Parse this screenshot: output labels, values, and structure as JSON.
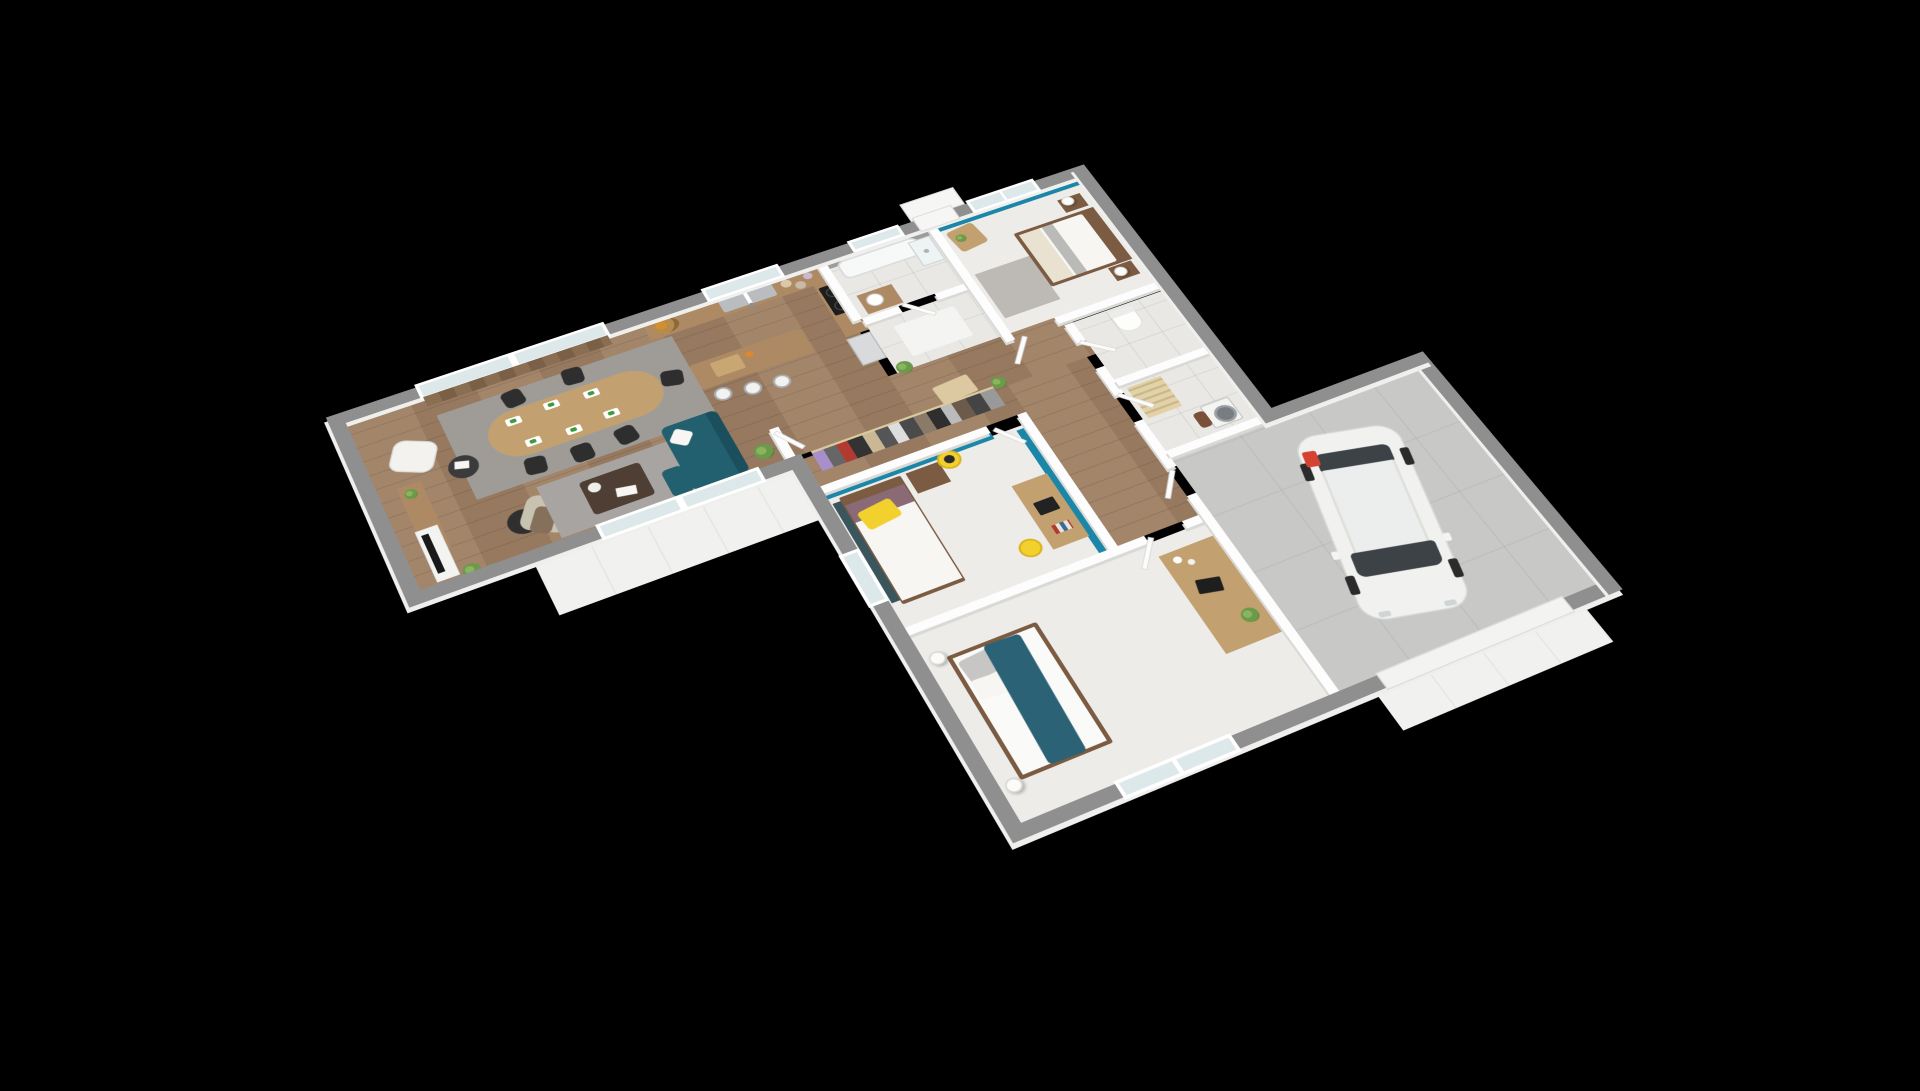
{
  "scene": {
    "title": "3D isometric floor plan render of a single-storey house with garage",
    "background": "#000000",
    "view": "rotated top-down axonometric, house floats on black"
  },
  "palette": {
    "bg": "#000000",
    "wall_ext": "#8f8f8f",
    "wall_ext_face": "#efefed",
    "wall_int": "#fdfdfd",
    "wall_int_shadow": "#d9d9d6",
    "wood_floor_a": "#a3856a",
    "wood_floor_b": "#97795f",
    "tile": "#e9e8e5",
    "carpet": "#edece9",
    "concrete": "#c8c8c6",
    "terrace": "#f1f1ef",
    "accent_teal": "#1b86a8",
    "sofa_teal": "#23606f",
    "throw_teal": "#2b6275",
    "accent_yellow": "#f2d12e",
    "wood_light": "#c3a06f",
    "wood_mid": "#ad8a63",
    "wood_dark": "#7b5b41",
    "coffee_table": "#4e3e34",
    "rug_gray": "#9f9c98",
    "rug_light": "#a7a4a1",
    "chair_black": "#2e2e2e",
    "armchair_beige": "#c8c2b0",
    "throw_brown": "#85705c",
    "plant_green": "#6a9a4a",
    "car_white": "#f1f1ef",
    "car_glass": "#3c4246",
    "red_accent": "#d64232",
    "steel": "#b9bdc0",
    "glass": "#dde8eb"
  },
  "rooms": {
    "living_dining": {
      "label": "Living / dining room",
      "floor": "wood"
    },
    "kitchen": {
      "label": "Kitchen",
      "floor": "wood"
    },
    "bathroom": {
      "label": "Bathroom",
      "floor": "tile"
    },
    "entry": {
      "label": "Entrance hall",
      "floor": "tile"
    },
    "bedroom_master": {
      "label": "Master bedroom",
      "floor": "carpet",
      "accent_wall": "teal"
    },
    "hallway": {
      "label": "Hallway",
      "floor": "wood"
    },
    "dressing": {
      "label": "Dressing / wardrobe",
      "floor": "wood"
    },
    "bedroom_middle": {
      "label": "Bedroom 2 (yellow accents)",
      "floor": "carpet",
      "accent_wall": "teal"
    },
    "wc": {
      "label": "WC",
      "floor": "tile"
    },
    "laundry": {
      "label": "Laundry room",
      "floor": "tile"
    },
    "bedroom_bottom": {
      "label": "Bedroom 3 (teal throw)",
      "floor": "carpet"
    },
    "garage": {
      "label": "Garage",
      "floor": "concrete"
    },
    "terrace": {
      "label": "Terrace",
      "floor": "white slab"
    },
    "driveway": {
      "label": "Garage apron",
      "floor": "white slab"
    }
  },
  "objects": {
    "living_dining": [
      "oval wood dining table",
      "six black chairs",
      "green place settings",
      "gray dining rug",
      "white lounge chair",
      "black side table with books",
      "sideboard",
      "white TV unit with black TV",
      "arc floor lamp",
      "beige armchair with brown throw",
      "dark coffee table with white flowers and magazines",
      "teal corner sofa with white cushion",
      "potted plants",
      "sliding glass door north",
      "sliding glass door south",
      "wood slat curtain"
    ],
    "kitchen": [
      "L-shaped counter with wood top",
      "double steel sink",
      "window above sink",
      "fruit bowl",
      "storage jars",
      "black cooktop",
      "tall fridge",
      "island with cutting board",
      "three white bar stools"
    ],
    "bathroom": [
      "bathtub",
      "glass shower screen",
      "wood vanity with round basin",
      "gray wall tiles"
    ],
    "entry": [
      "white rug",
      "potted plant",
      "front door"
    ],
    "bedroom_master": [
      "double bed white duvet",
      "wood headboard",
      "two nightstands",
      "two sphere lamps",
      "gray runner rug",
      "corner desk with plant",
      "teal window wall"
    ],
    "dressing": [
      "open rail with hanging clothes",
      "plant on half wall"
    ],
    "bedroom_middle": [
      "single bed with yellow pillow",
      "plum sheet",
      "wood nightstand",
      "round yellow mirror",
      "wood desk with laptop and books",
      "yellow chair",
      "window west"
    ],
    "wc": [
      "toilet"
    ],
    "laundry": [
      "washing machine",
      "wooden drying rack"
    ],
    "bedroom_bottom": [
      "double bed with teal throw",
      "gray and white pillows",
      "two round floor lamps",
      "long wood dresser with laptop and plant",
      "window south"
    ],
    "garage": [
      "white hatchback car",
      "red object at rear",
      "garage door opening south"
    ],
    "exterior": [
      "white terrace slab",
      "garage apron"
    ]
  }
}
